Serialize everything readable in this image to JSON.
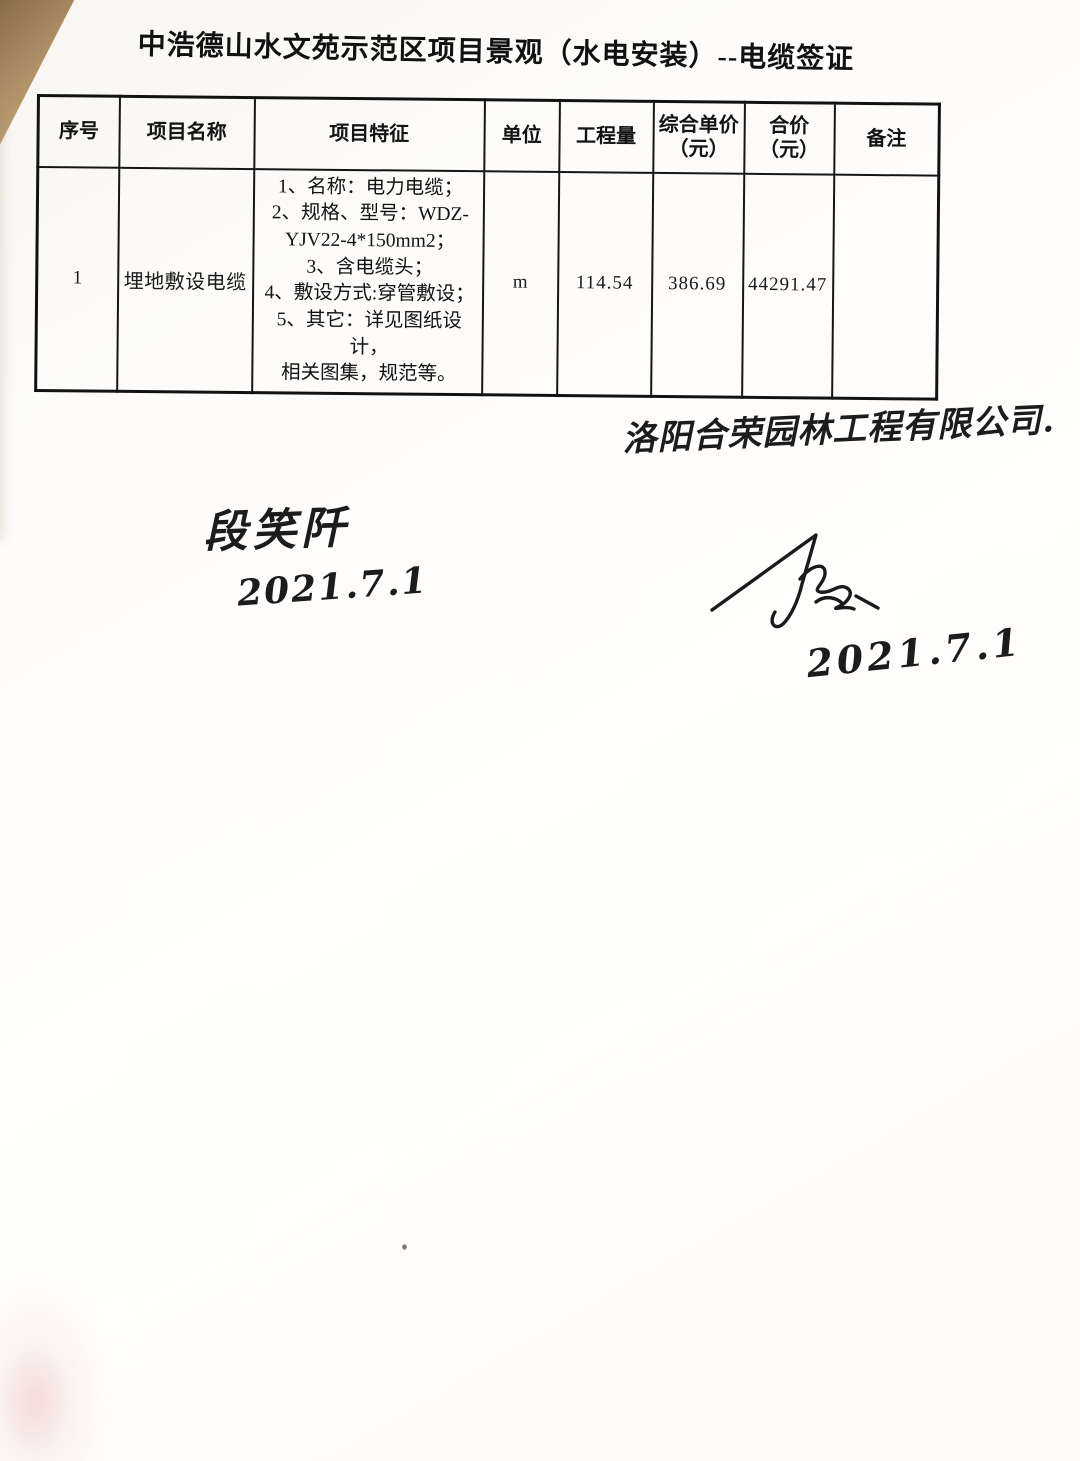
{
  "document": {
    "title": "中浩德山水文苑示范区项目景观（水电安装）--电缆签证",
    "table": {
      "columns": [
        {
          "label": "序号"
        },
        {
          "label": "项目名称"
        },
        {
          "label": "项目特征"
        },
        {
          "label": "单位"
        },
        {
          "label": "工程量"
        },
        {
          "label": "综合单价",
          "sub": "（元）"
        },
        {
          "label": "合价",
          "sub": "（元）"
        },
        {
          "label": "备注"
        }
      ],
      "rows": [
        {
          "seq": "1",
          "name": "埋地敷设电缆",
          "features": "1、名称：电力电缆；\n2、规格、型号：WDZ-\nYJV22-4*150mm2；\n3、含电缆头；\n4、敷设方式:穿管敷设；\n5、其它：详见图纸设计，\n相关图集，规范等。",
          "unit": "m",
          "quantity": "114.54",
          "unit_price": "386.69",
          "total_price": "44291.47",
          "remark": ""
        }
      ]
    },
    "handwriting": {
      "company": "洛阳合荣园林工程有限公司.",
      "signer_name": "段笑阡",
      "signer_date": "2021.7.1",
      "approver_date": "2021.7.1"
    }
  }
}
